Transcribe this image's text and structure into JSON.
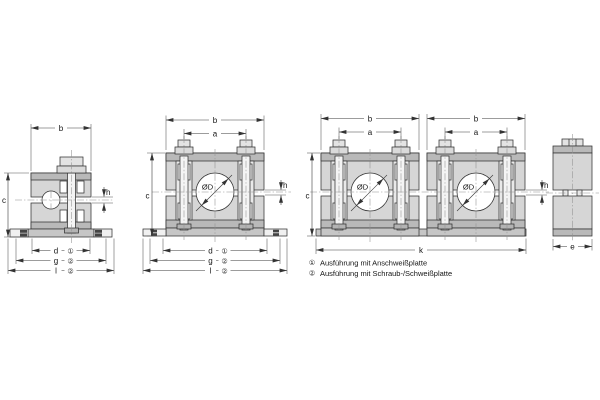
{
  "drawing": {
    "dimension_labels": {
      "b": "b",
      "a": "a",
      "c": "c",
      "h": "h",
      "d": "d",
      "g": "g",
      "l": "l",
      "k": "k",
      "e": "e",
      "diameter": "ØD"
    },
    "reference_marks": {
      "r1": "①",
      "r2": "②"
    },
    "legend": {
      "items": [
        {
          "ref": "①",
          "text": "Ausführung mit Anschweißplatte"
        },
        {
          "ref": "②",
          "text": "Ausführung mit Schraub-/Schweißplatte"
        }
      ]
    },
    "colors": {
      "body": "#d6d6d6",
      "strips": "#b9b9b9",
      "plate": "#c6c6c6",
      "outline": "#333333"
    }
  }
}
